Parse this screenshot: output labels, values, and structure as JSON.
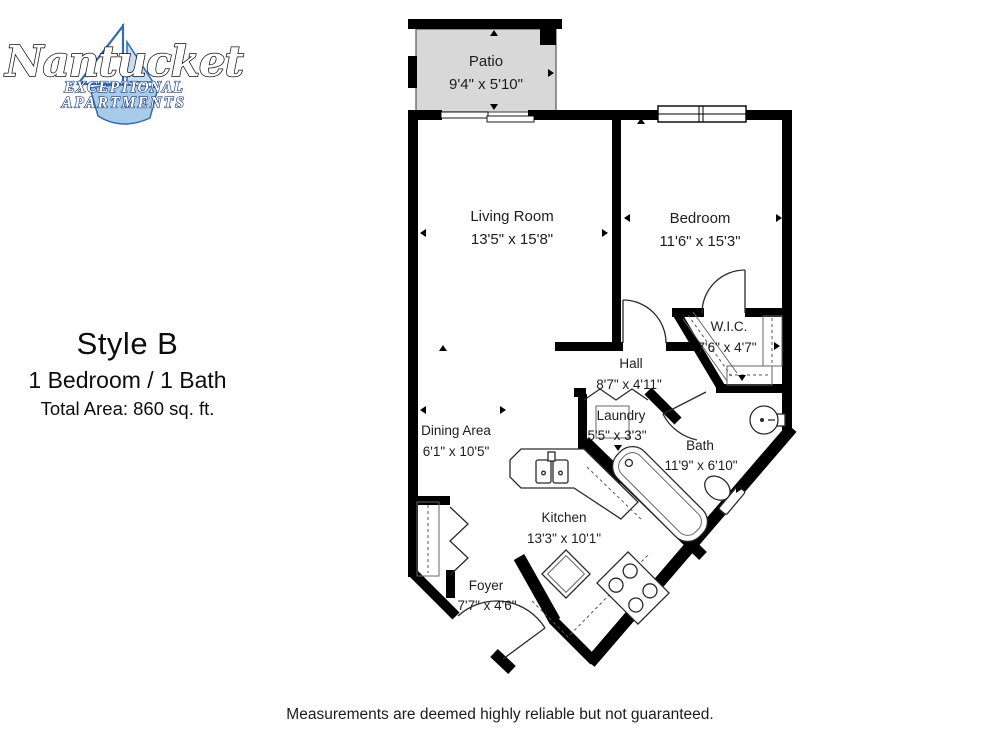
{
  "logo": {
    "name": "Nantucket",
    "tagline_line1": "EXCEPTIONAL",
    "tagline_line2": "APARTMENTS"
  },
  "plan_info": {
    "style": "Style B",
    "config": "1 Bedroom / 1 Bath",
    "area": "Total Area: 860 sq. ft."
  },
  "footer": {
    "disclaimer": "Measurements are deemed highly reliable but not guaranteed."
  },
  "rooms": {
    "patio": {
      "name": "Patio",
      "dims": "9'4\" x 5'10\""
    },
    "living": {
      "name": "Living Room",
      "dims": "13'5\" x 15'8\""
    },
    "bedroom": {
      "name": "Bedroom",
      "dims": "11'6\" x 15'3\""
    },
    "wic": {
      "name": "W.I.C.",
      "dims": "7'6\" x 4'7\""
    },
    "hall": {
      "name": "Hall",
      "dims": "8'7\" x 4'11\""
    },
    "laundry": {
      "name": "Laundry",
      "dims": "5'5\" x 3'3\""
    },
    "bath": {
      "name": "Bath",
      "dims": "11'9\" x 6'10\""
    },
    "dining": {
      "name": "Dining Area",
      "dims": "6'1\" x 10'5\""
    },
    "kitchen": {
      "name": "Kitchen",
      "dims": "13'3\" x 10'1\""
    },
    "foyer": {
      "name": "Foyer",
      "dims": "7'7\" x 4'6\""
    }
  },
  "colors": {
    "wall": "#000000",
    "patio_fill": "#d8d8d8",
    "logo_blue": "#2e6db4",
    "logo_light_blue": "#a8cbea",
    "text": "#1d1d1d"
  }
}
